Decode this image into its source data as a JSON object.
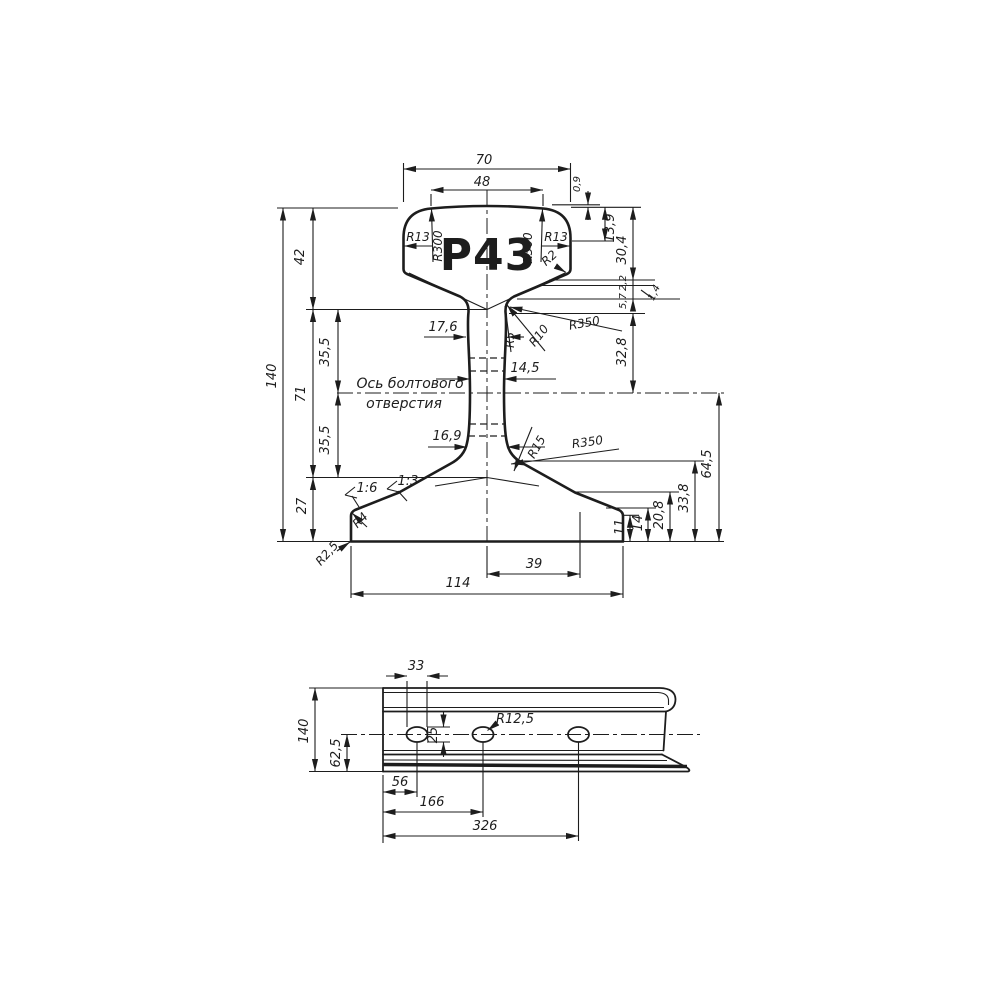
{
  "drawing_title": "Р43",
  "colors": {
    "ink": "#1d1d1d",
    "paper": "#ffffff"
  },
  "cross_section": {
    "title": "Р43",
    "note1": "Ось болтового",
    "note2": "отверстия",
    "d70": "70",
    "d48": "48",
    "d0_9": "0,9",
    "d13_9": "13,9",
    "d30_4": "30,4",
    "d2_2": "2,2",
    "d5_7": "5,7",
    "d1_4": "1,4",
    "d32_8": "32,8",
    "d64_5": "64,5",
    "d33_8": "33,8",
    "d20_8": "20,8",
    "d14": "14",
    "d11": "11",
    "d140": "140",
    "d42": "42",
    "d71": "71",
    "d27": "27",
    "d35_5a": "35,5",
    "d35_5b": "35,5",
    "d17_6": "17,6",
    "d14_5": "14,5",
    "d16_9": "16,9",
    "d39": "39",
    "d114": "114",
    "slope_outer": "1:6",
    "slope_inner": "1:3",
    "r13l": "R13",
    "r300l": "R300",
    "r300r": "R300",
    "r13r": "R13",
    "r2": "R2",
    "r5": "R5",
    "r10": "R10",
    "r350u": "R350",
    "r15": "R15",
    "r350l": "R350",
    "r4": "R4",
    "r2_5": "R2,5"
  },
  "side_view": {
    "d33": "33",
    "d140": "140",
    "d62_5": "62,5",
    "d25": "25",
    "r12_5": "R12,5",
    "d56": "56",
    "d166": "166",
    "d326": "326"
  }
}
